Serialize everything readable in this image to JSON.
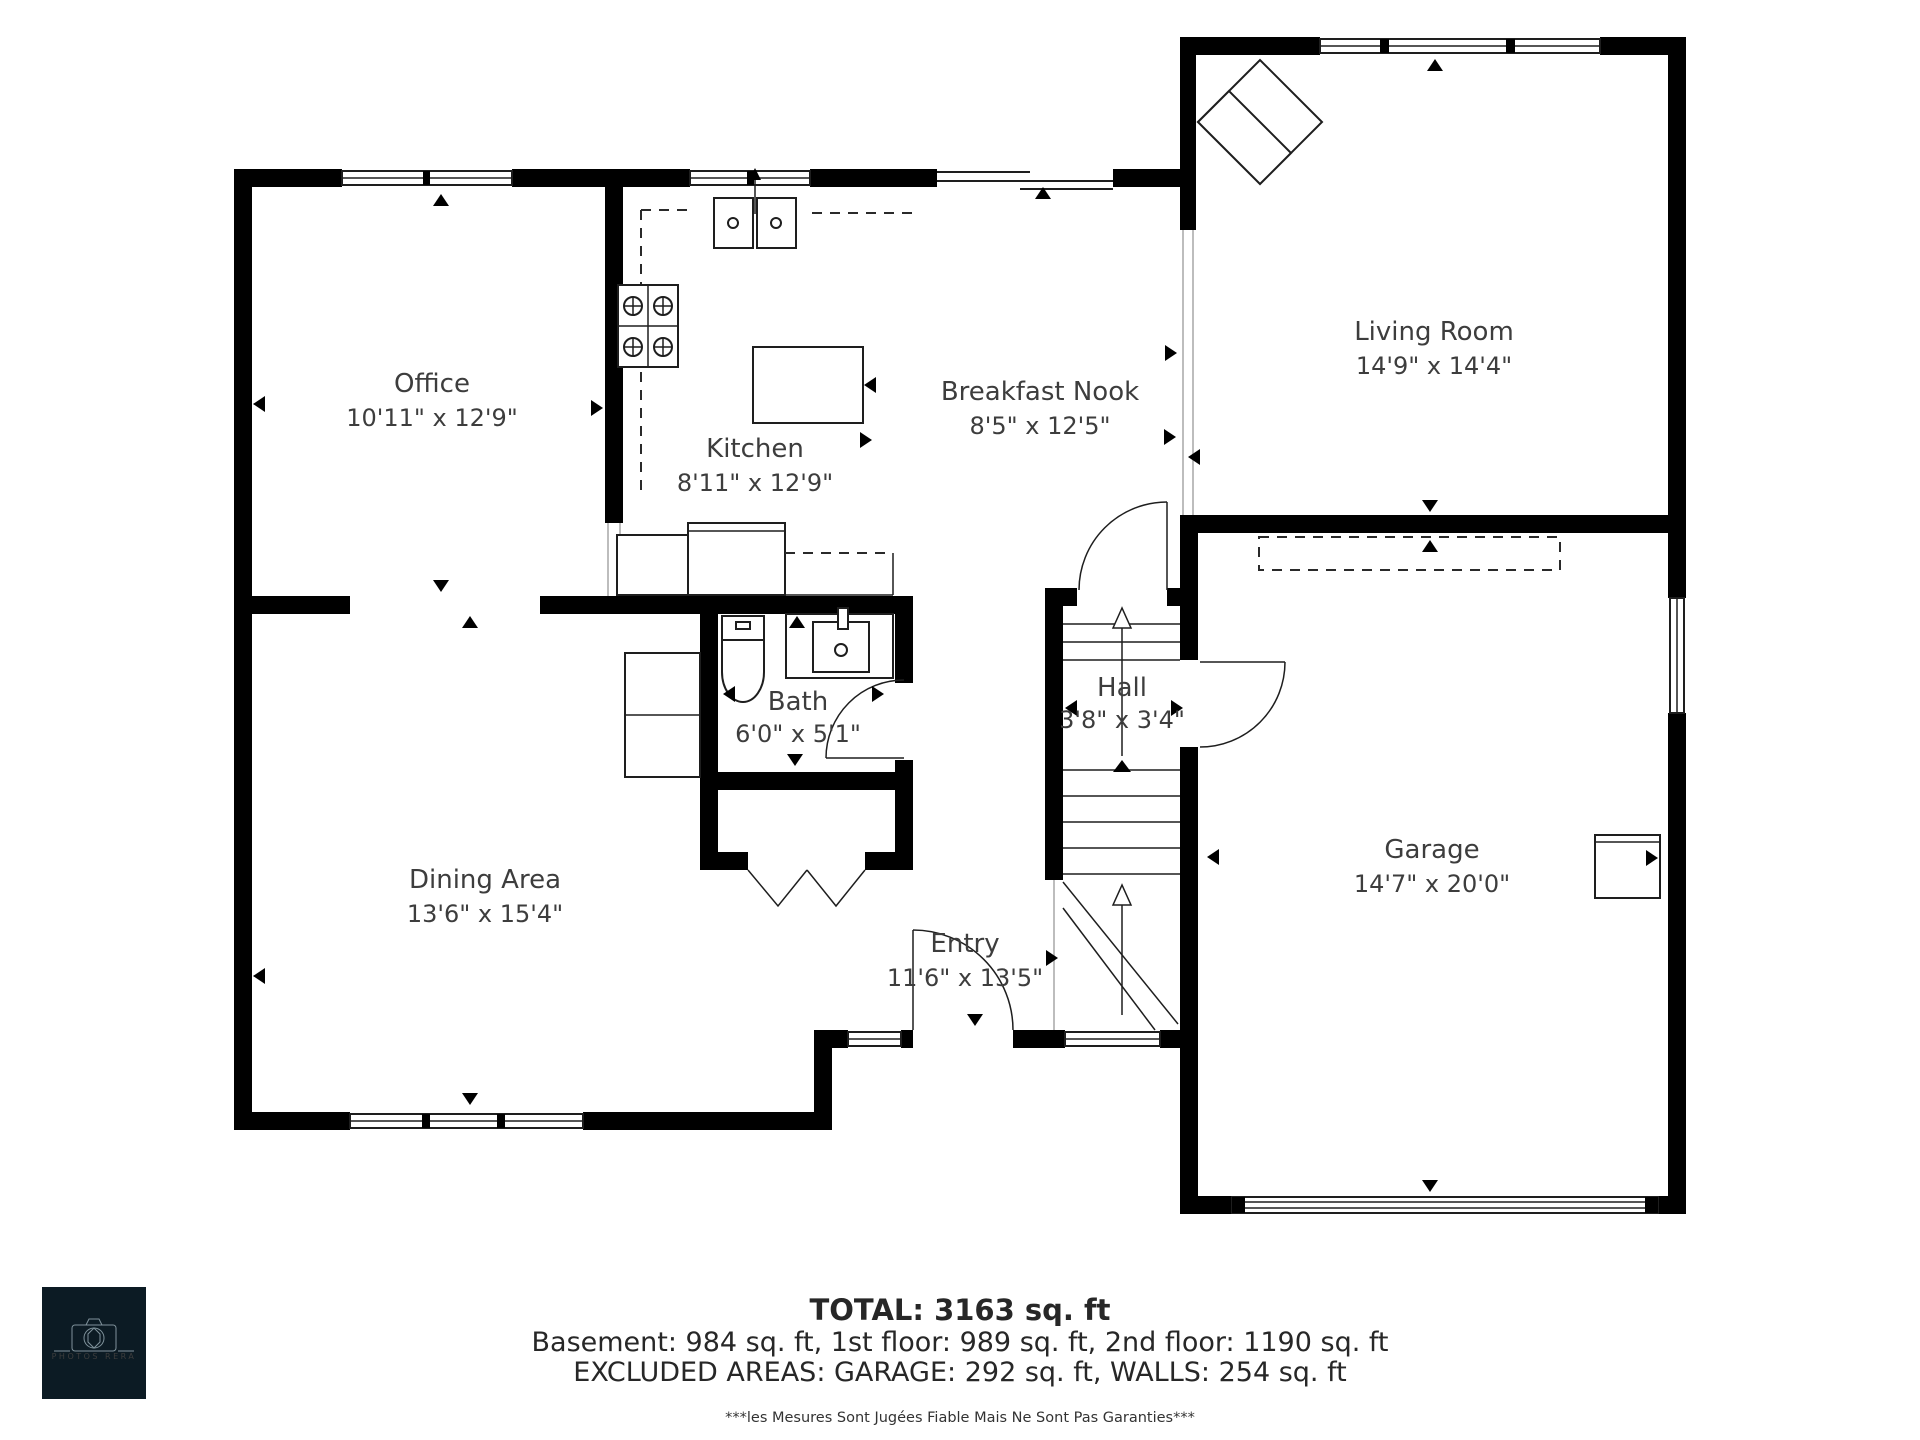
{
  "rooms": {
    "office": {
      "name": "Office",
      "dims": "10'11\" x 12'9\""
    },
    "kitchen": {
      "name": "Kitchen",
      "dims": "8'11\" x 12'9\""
    },
    "breakfast_nook": {
      "name": "Breakfast Nook",
      "dims": "8'5\" x 12'5\""
    },
    "living_room": {
      "name": "Living Room",
      "dims": "14'9\" x 14'4\""
    },
    "dining_area": {
      "name": "Dining Area",
      "dims": "13'6\" x 15'4\""
    },
    "bath": {
      "name": "Bath",
      "dims": "6'0\" x 5'1\""
    },
    "hall": {
      "name": "Hall",
      "dims": "3'8\" x 3'4\""
    },
    "entry": {
      "name": "Entry",
      "dims": "11'6\" x 13'5\""
    },
    "garage": {
      "name": "Garage",
      "dims": "14'7\" x 20'0\""
    }
  },
  "summary": {
    "total": "TOTAL: 3163 sq. ft",
    "floors": "Basement: 984 sq. ft, 1st floor: 989 sq. ft, 2nd floor: 1190 sq. ft",
    "excluded": "EXCLUDED AREAS: GARAGE: 292 sq. ft, WALLS: 254 sq. ft",
    "disclaimer": "***les Mesures Sont Jugées Fiable Mais Ne Sont Pas Garanties***"
  },
  "logo": {
    "text": "PHOTOS RERA"
  },
  "colors": {
    "wall": "#000000",
    "background": "#ffffff",
    "label_text": "#3d3d3d",
    "logo_bg": "#0c1b24"
  }
}
